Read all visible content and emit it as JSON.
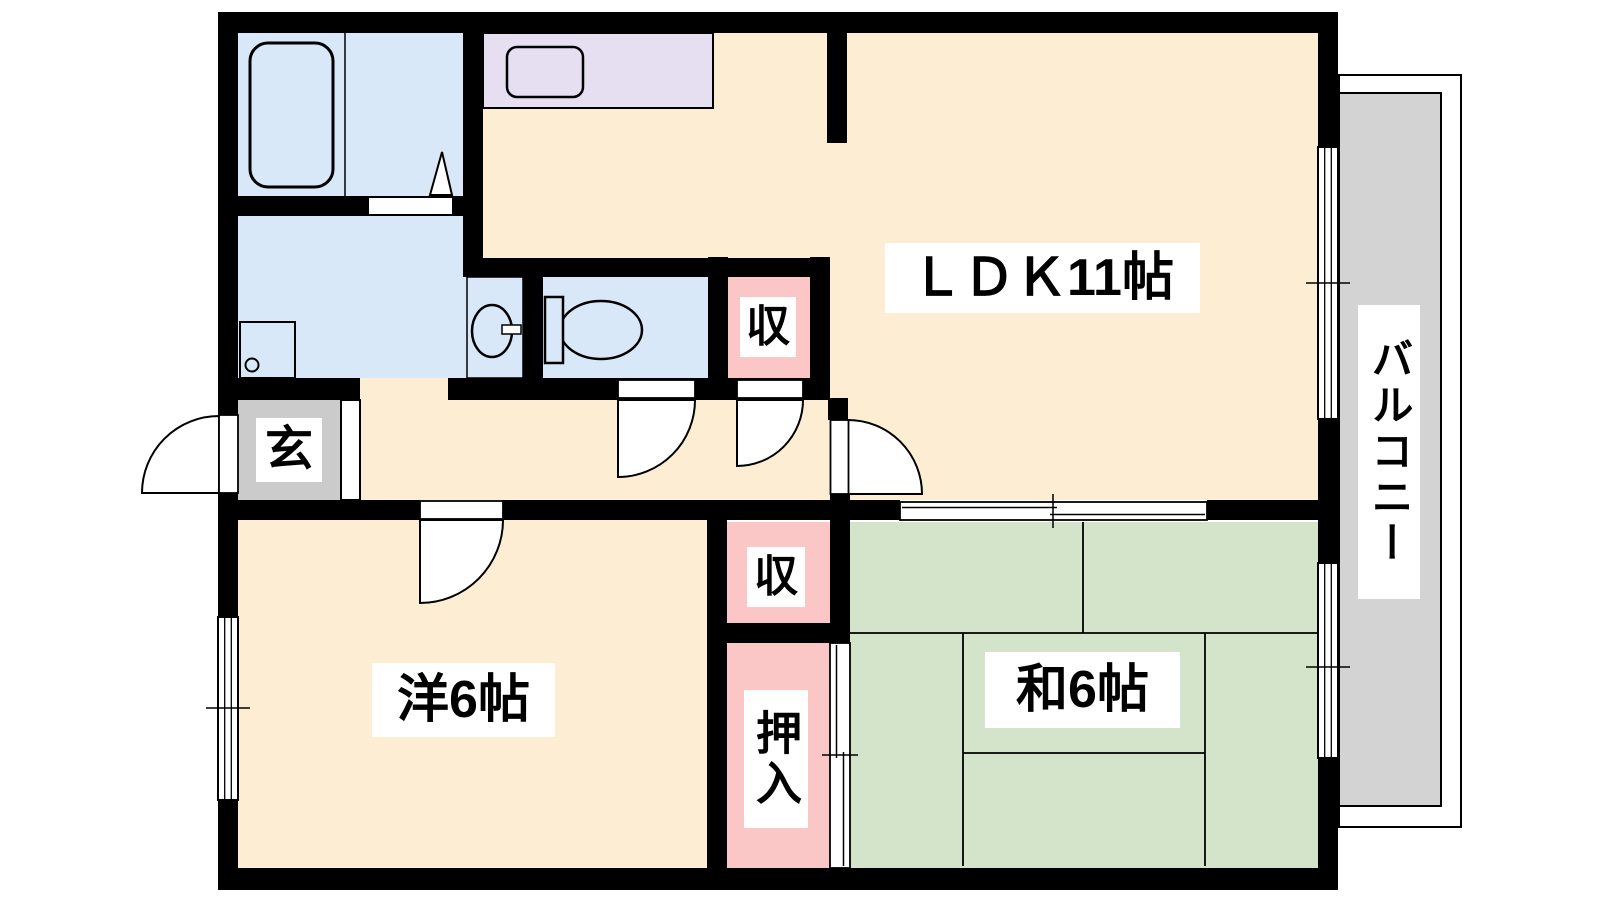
{
  "plan_title": "apartment-floor-plan",
  "rooms": {
    "ldk": {
      "label": "ＬＤＫ11帖"
    },
    "western_room": {
      "label": "洋6帖"
    },
    "japanese_room": {
      "label": "和6帖"
    },
    "balcony": {
      "label": "バルコニー"
    },
    "entrance": {
      "label": "玄"
    },
    "closet_upper": {
      "label": "収"
    },
    "closet_lower": {
      "label": "収"
    },
    "oshiire": {
      "label": "押入"
    }
  },
  "fixtures": {
    "bathtub": "bathtub",
    "kitchen_counter": "kitchen-counter",
    "kitchen_sink": "kitchen-sink",
    "washing_machine": "washing-machine-pan",
    "washbasin": "washbasin-vanity",
    "toilet": "toilet"
  },
  "colors": {
    "floor": "#fdeed3",
    "wet_area": "#d9e8f8",
    "kitchen_counter": "#e6dff2",
    "closet": "#fbc6c6",
    "tatami": "#d3e4ca",
    "balcony": "#d3d3d3",
    "entrance": "#cbcbcb",
    "wall": "#000000"
  }
}
